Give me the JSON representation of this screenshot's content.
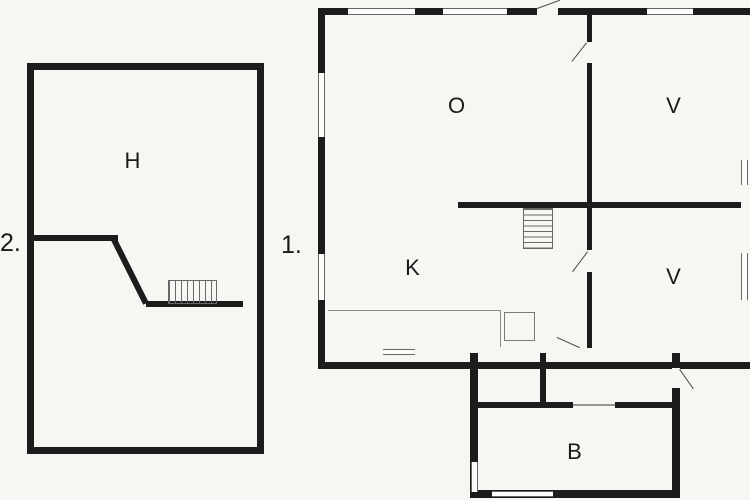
{
  "colors": {
    "wall": "#1c1c1c",
    "background": "#f7f6f3",
    "thin_line": "#666666"
  },
  "plan": {
    "floor_1": {
      "number_label": "1.",
      "rooms": {
        "o_room": "O",
        "v_room_upper": "V",
        "k_room": "K",
        "v_room_lower": "V",
        "b_room": "B"
      }
    },
    "floor_2": {
      "number_label": "2.",
      "rooms": {
        "h_room": "H"
      }
    }
  }
}
